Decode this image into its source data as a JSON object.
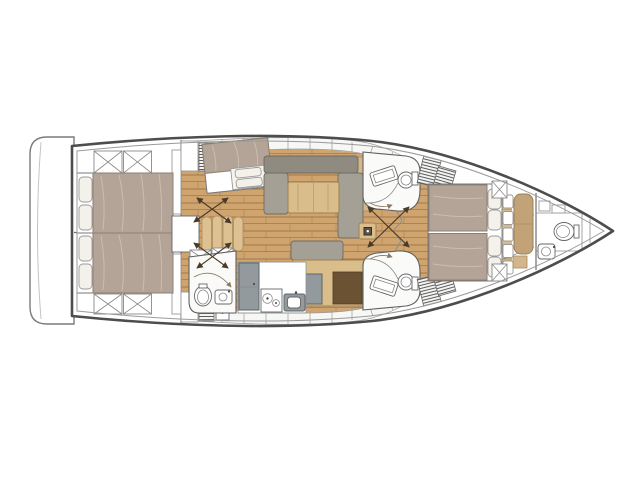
{
  "page": {
    "title": "Sailing yacht interior layout plan — bow to the right",
    "background": "#ffffff"
  },
  "palette": {
    "hullStroke": "#4d4d4d",
    "innerStroke": "#9a9a9a",
    "wall": "#6e6e6e",
    "wood": "#cfa46f",
    "woodLight": "#d9ba8b",
    "duvet": "#b4a497",
    "duvetEdge": "#8c7f72",
    "pillow": "#f4f1ea",
    "sofa": "#a5a095",
    "sofaBack": "#8f8b80",
    "table": "#d9bd8a",
    "tableEdge": "#a08050",
    "steps": "#ddc193",
    "bench": "#c2a277",
    "grayUnit": "#939a9e",
    "darkPanel": "#6b5233",
    "roomFill": "#fafaf8",
    "arrow": "#4a3b28"
  },
  "plan": {
    "type": "yacht-interior-floor-plan",
    "orientation": "bow-right",
    "rooms": [
      {
        "id": "swim-platform",
        "label": "Swim platform / transom"
      },
      {
        "id": "aft-cabin-port",
        "label": "Aft double cabin (port)"
      },
      {
        "id": "aft-cabin-starboard",
        "label": "Aft double cabin (starboard)"
      },
      {
        "id": "mid-cabin",
        "label": "Midship berth cabin"
      },
      {
        "id": "companionway",
        "label": "Companionway steps"
      },
      {
        "id": "salon",
        "label": "Saloon with U-shaped settee and table"
      },
      {
        "id": "nav-island",
        "label": "Island unit / chart table"
      },
      {
        "id": "galley",
        "label": "Galley with stove, sink and fridge"
      },
      {
        "id": "aft-head",
        "label": "Aft head and shower"
      },
      {
        "id": "head-port",
        "label": "Forward head (port)"
      },
      {
        "id": "head-starboard",
        "label": "Forward head (starboard)"
      },
      {
        "id": "owner-cabin",
        "label": "Owner's cabin with double berth"
      },
      {
        "id": "bow-head",
        "label": "Bow head"
      },
      {
        "id": "anchor-locker",
        "label": "Anchor locker"
      },
      {
        "id": "mast",
        "label": "Mast post"
      }
    ],
    "fixtures": {
      "double_berths": 4,
      "toilets": 4,
      "sinks": 7,
      "stove_burners": 2,
      "companionway_steps": 4,
      "ceiling_hatches": 8,
      "louvered_lockers": 6
    }
  }
}
